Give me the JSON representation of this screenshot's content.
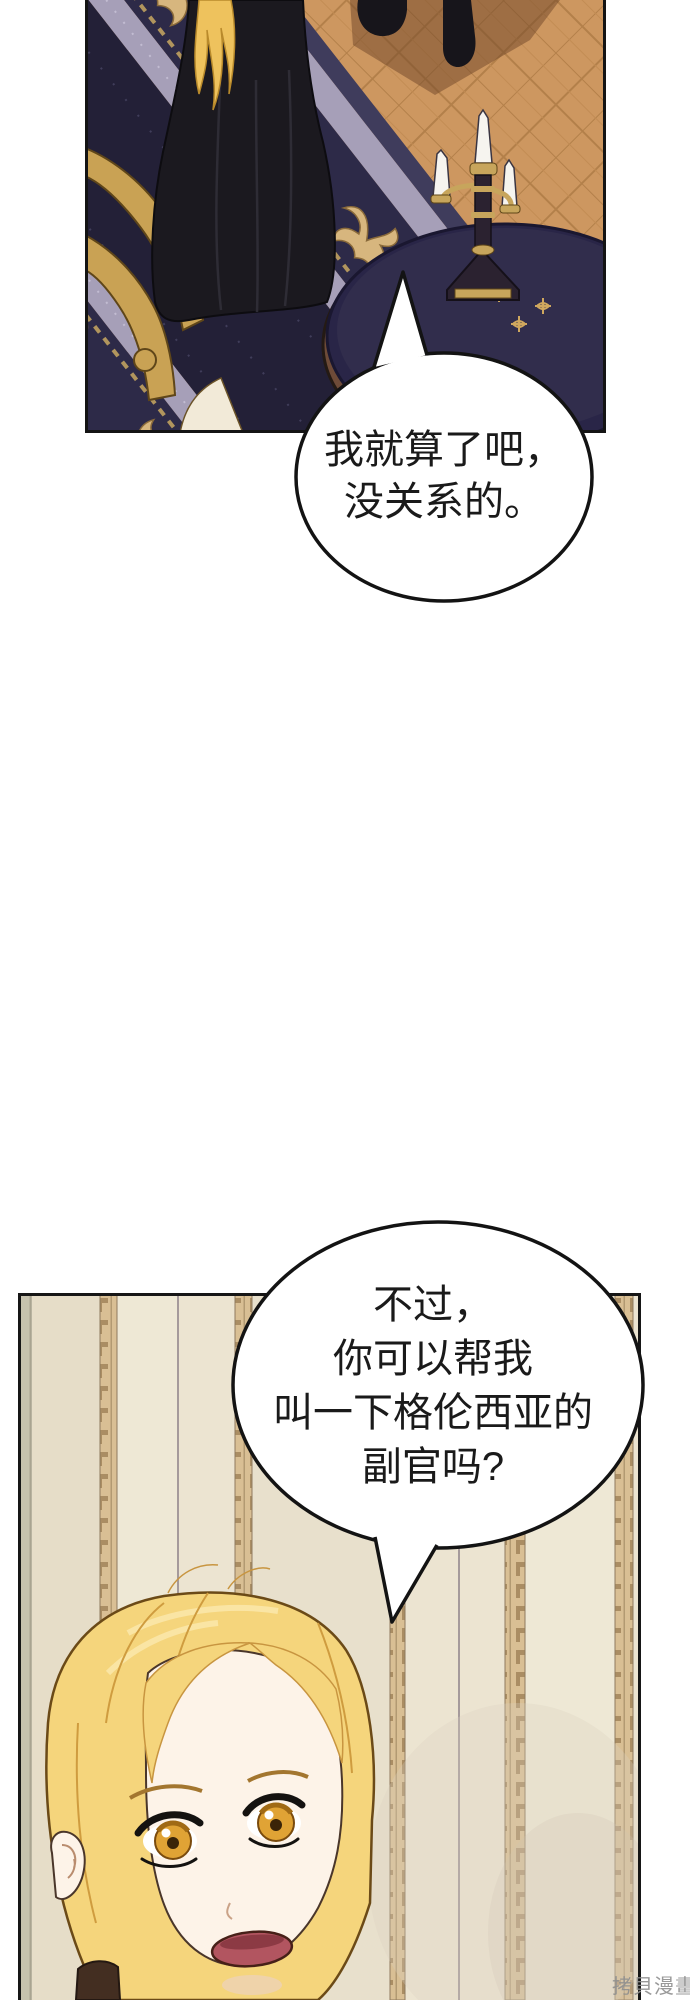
{
  "page": {
    "background": "#ffffff",
    "watermark": "拷貝漫畫"
  },
  "bubbles": [
    {
      "id": "bubble-1",
      "lines": [
        "我就算了吧，",
        "没关系的。"
      ]
    },
    {
      "id": "bubble-2",
      "lines": [
        "不过，",
        "你可以帮我",
        "叫一下格伦西亚的",
        "副官吗?"
      ]
    }
  ],
  "panels": [
    {
      "id": "panel-top",
      "label": "ballroom-scene"
    },
    {
      "id": "panel-bottom",
      "label": "blonde-woman-closeup"
    }
  ],
  "colors": {
    "panel_border": "#141414",
    "floor_tan": "#cd9760",
    "carpet_navy": "#232037",
    "carpet_gold": "#d7b67e",
    "carpet_lavender": "#a69fb8",
    "table_navy": "#2f2b49",
    "candle_white": "#f6f4ef",
    "brass_gold": "#c7a55c",
    "wallpaper_cream": "#ece4d1",
    "wallpaper_tan": "#d9bf94",
    "hair_blonde": "#f5d57c",
    "eye_amber": "#e0a335",
    "skin": "#fdf3e8",
    "mouth_rose": "#b25560",
    "watermark_gray": "#8f8f8f"
  }
}
